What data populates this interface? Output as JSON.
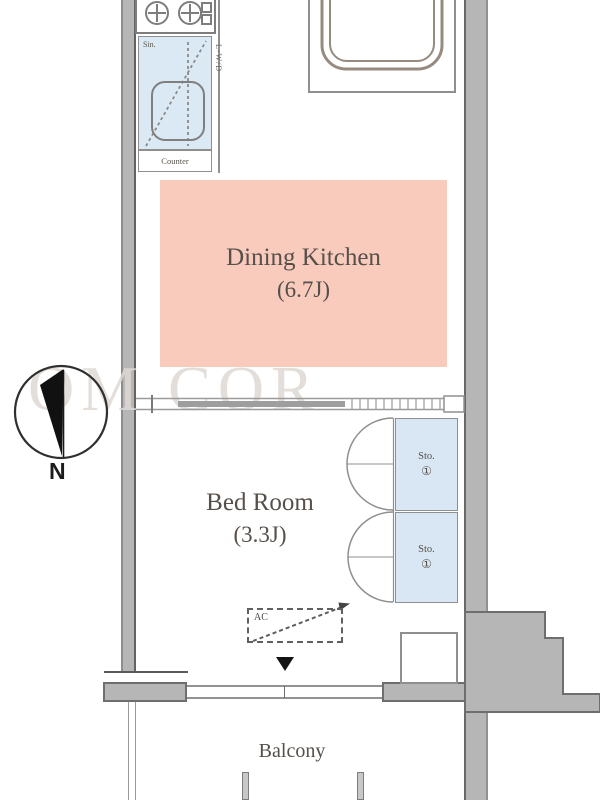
{
  "rooms": {
    "dining_kitchen": {
      "name": "Dining Kitchen",
      "size": "(6.7J)"
    },
    "bed_room": {
      "name": "Bed Room",
      "size": "(3.3J)"
    },
    "balcony": {
      "name": "Balcony"
    }
  },
  "fixtures": {
    "counter_label": "Counter",
    "sink_label": "Sin.",
    "laundry_label": "L-W/D",
    "ac_label": "AC",
    "storage_1": {
      "abbr": "Sto.",
      "number": "①"
    },
    "storage_2": {
      "abbr": "Sto.",
      "number": "①"
    }
  },
  "compass": {
    "north_label": "N"
  },
  "watermark": {
    "text": "OM COR"
  },
  "colors": {
    "room_fill_pink": "#f8cbbd",
    "storage_fill_blue": "#d9e7f4",
    "sink_fill_blue": "#dbe9f5",
    "wall_gray": "#b6b6b6",
    "label_text": "#564f4a"
  }
}
